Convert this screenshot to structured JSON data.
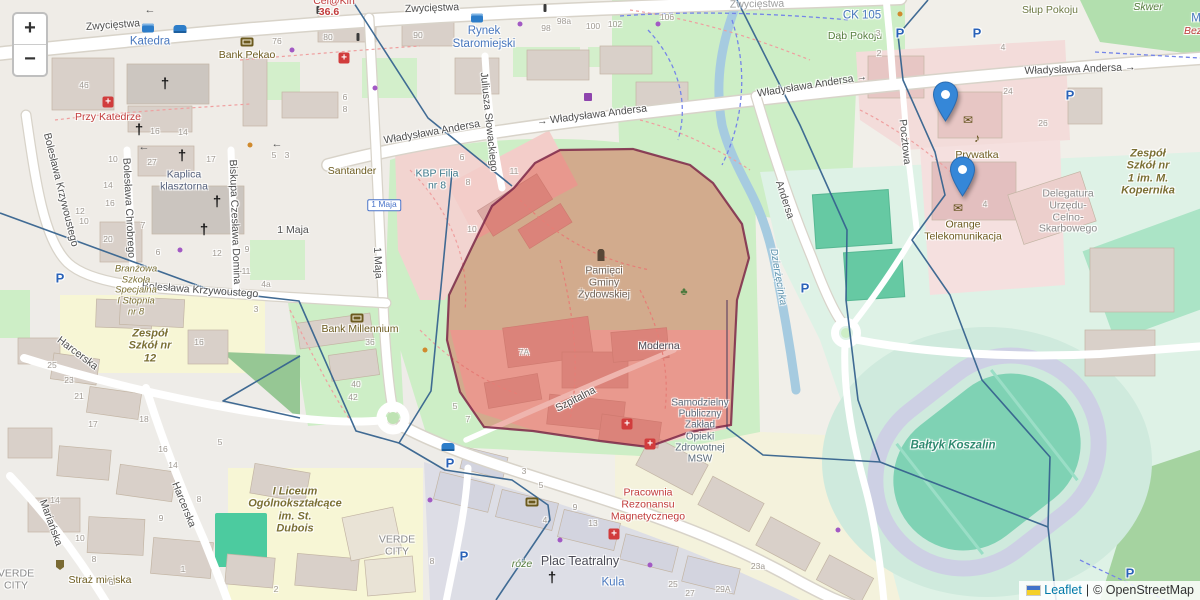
{
  "ui": {
    "zoom_in": "+",
    "zoom_out": "−",
    "attribution": {
      "leaflet_link": "Leaflet",
      "sep": "|",
      "copyright": "© OpenStreetMap"
    }
  },
  "colors": {
    "highlight_fill": "#d94f3f",
    "highlight_border": "#7d2748",
    "boundary_line": "#37648f",
    "marker_blue": "#3587d8",
    "park_green": "#cdeec6",
    "sports_teal": "#7fd2b4",
    "water": "#a6cbe0"
  },
  "markers": [
    {
      "name": "marker-1",
      "x": 945,
      "y": 121
    },
    {
      "name": "marker-2",
      "x": 962,
      "y": 196
    }
  ],
  "streets": [
    {
      "text": "Zwycięstwa",
      "x": 113,
      "y": 26,
      "rot": -4
    },
    {
      "text": "Zwycięstwa",
      "x": 432,
      "y": 9,
      "rot": -2
    },
    {
      "text": "Zwycięstwa",
      "x": 757,
      "y": 5,
      "rot": -1,
      "cls": "faded"
    },
    {
      "text": "Władysława Andersa",
      "x": 432,
      "y": 133,
      "rot": -10
    },
    {
      "text": "→ Władysława Andersa",
      "x": 592,
      "y": 116,
      "rot": -7
    },
    {
      "text": "Władysława Andersa →",
      "x": 812,
      "y": 86,
      "rot": -9
    },
    {
      "text": "Władysława Andersa →",
      "x": 1080,
      "y": 70,
      "rot": -2
    },
    {
      "text": "Andersa",
      "x": 784,
      "y": 200,
      "rot": 72
    },
    {
      "text": "1 Maja",
      "x": 293,
      "y": 231,
      "rot": 0
    },
    {
      "text": "1 Maja",
      "x": 377,
      "y": 263,
      "rot": 87
    },
    {
      "text": "Bolesława Krzywoustego",
      "x": 60,
      "y": 190,
      "rot": 76
    },
    {
      "text": "Bolesława Chrobrego",
      "x": 128,
      "y": 208,
      "rot": 87
    },
    {
      "text": "Biskupa Czesława Domina",
      "x": 234,
      "y": 222,
      "rot": 88
    },
    {
      "text": "Bolesława Krzywoustego",
      "x": 200,
      "y": 291,
      "rot": 4
    },
    {
      "text": "Harcerska",
      "x": 77,
      "y": 354,
      "rot": 37
    },
    {
      "text": "Harcerska",
      "x": 183,
      "y": 505,
      "rot": 68
    },
    {
      "text": "Mariańska",
      "x": 50,
      "y": 523,
      "rot": 70
    },
    {
      "text": "Szpitalna",
      "x": 576,
      "y": 400,
      "rot": -27
    },
    {
      "text": "Juliusza Słowackiego",
      "x": 488,
      "y": 122,
      "rot": 84
    },
    {
      "text": "Pocztowa",
      "x": 904,
      "y": 142,
      "rot": 84
    },
    {
      "text": "Dzierżęcinka",
      "x": 778,
      "y": 277,
      "rot": 80,
      "cls": "river"
    }
  ],
  "pois": [
    {
      "text": "Katedra",
      "x": 150,
      "y": 42,
      "cls": "poi-blue"
    },
    {
      "text": "Rynek\nStaromiejski",
      "x": 484,
      "y": 38,
      "cls": "poi-blue"
    },
    {
      "text": "Bank Pekao",
      "x": 247,
      "y": 56,
      "cls": "poi-olive"
    },
    {
      "text": "Przy Katedrze",
      "x": 108,
      "y": 118,
      "cls": "poi-red"
    },
    {
      "text": "Kaplica\nklasztorna",
      "x": 184,
      "y": 181,
      "cls": "poi-slate"
    },
    {
      "text": "Santander",
      "x": 352,
      "y": 172,
      "cls": "poi-olive"
    },
    {
      "text": "KBP Filia\nnr 8",
      "x": 437,
      "y": 180,
      "cls": "poi-teal"
    },
    {
      "text": "Bank Millennium",
      "x": 360,
      "y": 330,
      "cls": "poi-olive"
    },
    {
      "text": "Dąb Pokoju",
      "x": 855,
      "y": 37,
      "cls": "poi-green"
    },
    {
      "text": "Słup Pokoju",
      "x": 1050,
      "y": 11,
      "cls": "poi-olivegreen"
    },
    {
      "text": "CK 105",
      "x": 862,
      "y": 16,
      "cls": "poi-blue"
    },
    {
      "text": "Skwer",
      "x": 1148,
      "y": 8,
      "cls": "poi-green italic"
    },
    {
      "text": "M",
      "x": 1196,
      "y": 19,
      "cls": "poi-blue"
    },
    {
      "text": "Bez",
      "x": 1193,
      "y": 32,
      "cls": "poi-red italic"
    },
    {
      "text": "Prywatka",
      "x": 977,
      "y": 156,
      "cls": "poi-olive"
    },
    {
      "text": "Orange\nTelekomunikacja",
      "x": 963,
      "y": 231,
      "cls": "poi-olive"
    },
    {
      "text": "Delegatura\nUrzędu-\nCelno-\nSkarbowego",
      "x": 1068,
      "y": 212,
      "cls": "poi-gray"
    },
    {
      "text": "Zespół\nSzkół nr\n1 im. M.\nKopernika",
      "x": 1148,
      "y": 172,
      "cls": "poi-school"
    },
    {
      "text": "Pamięci\nGminy\nŻydowskiej",
      "x": 604,
      "y": 283,
      "cls": "poi-brown"
    },
    {
      "text": "Moderna",
      "x": 659,
      "y": 347,
      "cls": "poi-dark"
    },
    {
      "text": "Samodzielny\nPubliczny\nZakład\nOpieki\nZdrowotnej\nMSW",
      "x": 700,
      "y": 431,
      "cls": "poi-hospital"
    },
    {
      "text": "Pracownia\nRezonansu\nMagnetycznego",
      "x": 648,
      "y": 505,
      "cls": "poi-red"
    },
    {
      "text": "Bałtyk Koszalin",
      "x": 953,
      "y": 446,
      "cls": "poi-stadium"
    },
    {
      "text": "Zespół\nSzkół nr\n12",
      "x": 150,
      "y": 346,
      "cls": "poi-school"
    },
    {
      "text": "Branżowa\nSzkoła\nSpecjalna\nI Stopnia\nnr 8",
      "x": 136,
      "y": 291,
      "cls": "poi-school-sm"
    },
    {
      "text": "I Liceum\nOgólnokształcące\nim. St.\nDubois",
      "x": 295,
      "y": 510,
      "cls": "poi-school"
    },
    {
      "text": "VERDE\nCITY",
      "x": 397,
      "y": 546,
      "cls": "poi-gray"
    },
    {
      "text": "VERDE\nCITY",
      "x": 16,
      "y": 580,
      "cls": "poi-gray"
    },
    {
      "text": "Straż miejska",
      "x": 100,
      "y": 581,
      "cls": "poi-olive"
    },
    {
      "text": "Plac Teatralny",
      "x": 580,
      "y": 561,
      "cls": "poi-dark lg"
    },
    {
      "text": "Kula",
      "x": 613,
      "y": 583,
      "cls": "poi-blue"
    },
    {
      "text": "róże",
      "x": 522,
      "y": 565,
      "cls": "poi-green italic"
    },
    {
      "text": "Cel@Kin",
      "x": 334,
      "y": 2,
      "cls": "poi-red"
    },
    {
      "text": "36.6",
      "x": 329,
      "y": 13,
      "cls": "poi-red bold"
    },
    {
      "text": "1 Maja",
      "x": 384,
      "y": 205,
      "cls": "shield"
    }
  ],
  "housenumbers": [
    {
      "t": "46",
      "x": 84,
      "y": 86
    },
    {
      "t": "76",
      "x": 277,
      "y": 42
    },
    {
      "t": "80",
      "x": 328,
      "y": 38
    },
    {
      "t": "90",
      "x": 418,
      "y": 36
    },
    {
      "t": "98",
      "x": 546,
      "y": 29
    },
    {
      "t": "98a",
      "x": 564,
      "y": 22
    },
    {
      "t": "100",
      "x": 593,
      "y": 27
    },
    {
      "t": "102",
      "x": 615,
      "y": 25
    },
    {
      "t": "106",
      "x": 667,
      "y": 18
    },
    {
      "t": "16",
      "x": 155,
      "y": 132
    },
    {
      "t": "14",
      "x": 183,
      "y": 133
    },
    {
      "t": "27",
      "x": 152,
      "y": 163
    },
    {
      "t": "17",
      "x": 211,
      "y": 160
    },
    {
      "t": "10",
      "x": 113,
      "y": 160
    },
    {
      "t": "14",
      "x": 108,
      "y": 186
    },
    {
      "t": "16",
      "x": 110,
      "y": 204
    },
    {
      "t": "12",
      "x": 80,
      "y": 212
    },
    {
      "t": "10",
      "x": 84,
      "y": 222
    },
    {
      "t": "20",
      "x": 108,
      "y": 240
    },
    {
      "t": "7",
      "x": 143,
      "y": 226
    },
    {
      "t": "6",
      "x": 158,
      "y": 253
    },
    {
      "t": "12",
      "x": 217,
      "y": 254
    },
    {
      "t": "5",
      "x": 274,
      "y": 156
    },
    {
      "t": "3",
      "x": 287,
      "y": 156
    },
    {
      "t": "9",
      "x": 247,
      "y": 250
    },
    {
      "t": "11",
      "x": 246,
      "y": 272
    },
    {
      "t": "4a",
      "x": 266,
      "y": 285
    },
    {
      "t": "3",
      "x": 256,
      "y": 310
    },
    {
      "t": "4",
      "x": 1003,
      "y": 48
    },
    {
      "t": "24",
      "x": 1008,
      "y": 92
    },
    {
      "t": "26",
      "x": 1043,
      "y": 124
    },
    {
      "t": "3",
      "x": 878,
      "y": 34
    },
    {
      "t": "2",
      "x": 879,
      "y": 54
    },
    {
      "t": "4",
      "x": 985,
      "y": 205
    },
    {
      "t": "7A",
      "x": 524,
      "y": 353
    },
    {
      "t": "36",
      "x": 370,
      "y": 343
    },
    {
      "t": "40",
      "x": 356,
      "y": 385
    },
    {
      "t": "42",
      "x": 353,
      "y": 398
    },
    {
      "t": "5",
      "x": 455,
      "y": 407
    },
    {
      "t": "7",
      "x": 468,
      "y": 420
    },
    {
      "t": "25",
      "x": 52,
      "y": 366
    },
    {
      "t": "23",
      "x": 69,
      "y": 381
    },
    {
      "t": "21",
      "x": 79,
      "y": 397
    },
    {
      "t": "17",
      "x": 93,
      "y": 425
    },
    {
      "t": "18",
      "x": 144,
      "y": 420
    },
    {
      "t": "16",
      "x": 163,
      "y": 450
    },
    {
      "t": "14",
      "x": 173,
      "y": 466
    },
    {
      "t": "16",
      "x": 199,
      "y": 343
    },
    {
      "t": "5",
      "x": 220,
      "y": 443
    },
    {
      "t": "9",
      "x": 161,
      "y": 519
    },
    {
      "t": "8",
      "x": 199,
      "y": 500
    },
    {
      "t": "1",
      "x": 183,
      "y": 570
    },
    {
      "t": "14",
      "x": 55,
      "y": 501
    },
    {
      "t": "10",
      "x": 80,
      "y": 539
    },
    {
      "t": "8",
      "x": 94,
      "y": 560
    },
    {
      "t": "6",
      "x": 111,
      "y": 583
    },
    {
      "t": "2",
      "x": 276,
      "y": 590
    },
    {
      "t": "23a",
      "x": 758,
      "y": 567
    },
    {
      "t": "29A",
      "x": 723,
      "y": 590
    },
    {
      "t": "25",
      "x": 673,
      "y": 585
    },
    {
      "t": "27",
      "x": 690,
      "y": 594
    },
    {
      "t": "13",
      "x": 593,
      "y": 524
    },
    {
      "t": "9",
      "x": 575,
      "y": 508
    },
    {
      "t": "5",
      "x": 541,
      "y": 486
    },
    {
      "t": "3",
      "x": 524,
      "y": 472
    },
    {
      "t": "4",
      "x": 545,
      "y": 521
    },
    {
      "t": "8",
      "x": 432,
      "y": 562
    },
    {
      "t": "6",
      "x": 345,
      "y": 98
    },
    {
      "t": "8",
      "x": 345,
      "y": 110
    },
    {
      "t": "11",
      "x": 514,
      "y": 172
    },
    {
      "t": "6",
      "x": 462,
      "y": 158
    },
    {
      "t": "8",
      "x": 468,
      "y": 183
    },
    {
      "t": "10",
      "x": 472,
      "y": 230
    }
  ],
  "icon_glyphs": {
    "church-cross": "†",
    "parking": "P",
    "mail": "✉",
    "music": "♪",
    "oneway-arrow": "←",
    "tree": "♣",
    "hospital-cross": "+",
    "bus": "",
    "car": "",
    "bank": "",
    "cart": "",
    "monument": "",
    "traffic": "",
    "dot-purple": "",
    "dot-orange": "",
    "badge": ""
  },
  "icons": [
    {
      "type": "church-cross",
      "x": 165,
      "y": 84
    },
    {
      "type": "church-cross",
      "x": 139,
      "y": 130
    },
    {
      "type": "church-cross",
      "x": 182,
      "y": 156
    },
    {
      "type": "church-cross",
      "x": 217,
      "y": 202
    },
    {
      "type": "church-cross",
      "x": 204,
      "y": 230
    },
    {
      "type": "church-cross",
      "x": 552,
      "y": 578
    },
    {
      "type": "hospital-cross",
      "x": 108,
      "y": 102
    },
    {
      "type": "hospital-cross",
      "x": 344,
      "y": 58
    },
    {
      "type": "hospital-cross",
      "x": 627,
      "y": 424
    },
    {
      "type": "hospital-cross",
      "x": 650,
      "y": 444
    },
    {
      "type": "hospital-cross",
      "x": 614,
      "y": 534
    },
    {
      "type": "parking",
      "x": 60,
      "y": 278
    },
    {
      "type": "parking",
      "x": 900,
      "y": 33
    },
    {
      "type": "parking",
      "x": 977,
      "y": 33
    },
    {
      "type": "parking",
      "x": 1070,
      "y": 95
    },
    {
      "type": "parking",
      "x": 805,
      "y": 288
    },
    {
      "type": "parking",
      "x": 450,
      "y": 463
    },
    {
      "type": "parking",
      "x": 464,
      "y": 556
    },
    {
      "type": "parking",
      "x": 1130,
      "y": 573
    },
    {
      "type": "bus",
      "x": 148,
      "y": 28
    },
    {
      "type": "bus",
      "x": 477,
      "y": 18
    },
    {
      "type": "car",
      "x": 180,
      "y": 29
    },
    {
      "type": "car",
      "x": 448,
      "y": 447
    },
    {
      "type": "bank",
      "x": 247,
      "y": 42
    },
    {
      "type": "bank",
      "x": 357,
      "y": 318
    },
    {
      "type": "bank",
      "x": 532,
      "y": 502
    },
    {
      "type": "mail",
      "x": 968,
      "y": 120
    },
    {
      "type": "mail",
      "x": 958,
      "y": 208
    },
    {
      "type": "music",
      "x": 977,
      "y": 138
    },
    {
      "type": "cart",
      "x": 588,
      "y": 97
    },
    {
      "type": "oneway-arrow",
      "x": 150,
      "y": 10
    },
    {
      "type": "oneway-arrow",
      "x": 144,
      "y": 147
    },
    {
      "type": "oneway-arrow",
      "x": 277,
      "y": 144
    },
    {
      "type": "tree",
      "x": 684,
      "y": 292
    },
    {
      "type": "monument",
      "x": 601,
      "y": 254
    },
    {
      "type": "traffic",
      "x": 318,
      "y": 10
    },
    {
      "type": "traffic",
      "x": 358,
      "y": 37
    },
    {
      "type": "traffic",
      "x": 545,
      "y": 8
    },
    {
      "type": "badge",
      "x": 60,
      "y": 565
    },
    {
      "type": "dot-purple",
      "x": 292,
      "y": 50
    },
    {
      "type": "dot-purple",
      "x": 520,
      "y": 24
    },
    {
      "type": "dot-purple",
      "x": 658,
      "y": 24
    },
    {
      "type": "dot-purple",
      "x": 375,
      "y": 88
    },
    {
      "type": "dot-purple",
      "x": 430,
      "y": 500
    },
    {
      "type": "dot-purple",
      "x": 560,
      "y": 540
    },
    {
      "type": "dot-purple",
      "x": 650,
      "y": 565
    },
    {
      "type": "dot-purple",
      "x": 838,
      "y": 530
    },
    {
      "type": "dot-purple",
      "x": 180,
      "y": 250
    },
    {
      "type": "dot-orange",
      "x": 250,
      "y": 145
    },
    {
      "type": "dot-orange",
      "x": 900,
      "y": 14
    },
    {
      "type": "dot-orange",
      "x": 425,
      "y": 350
    }
  ]
}
